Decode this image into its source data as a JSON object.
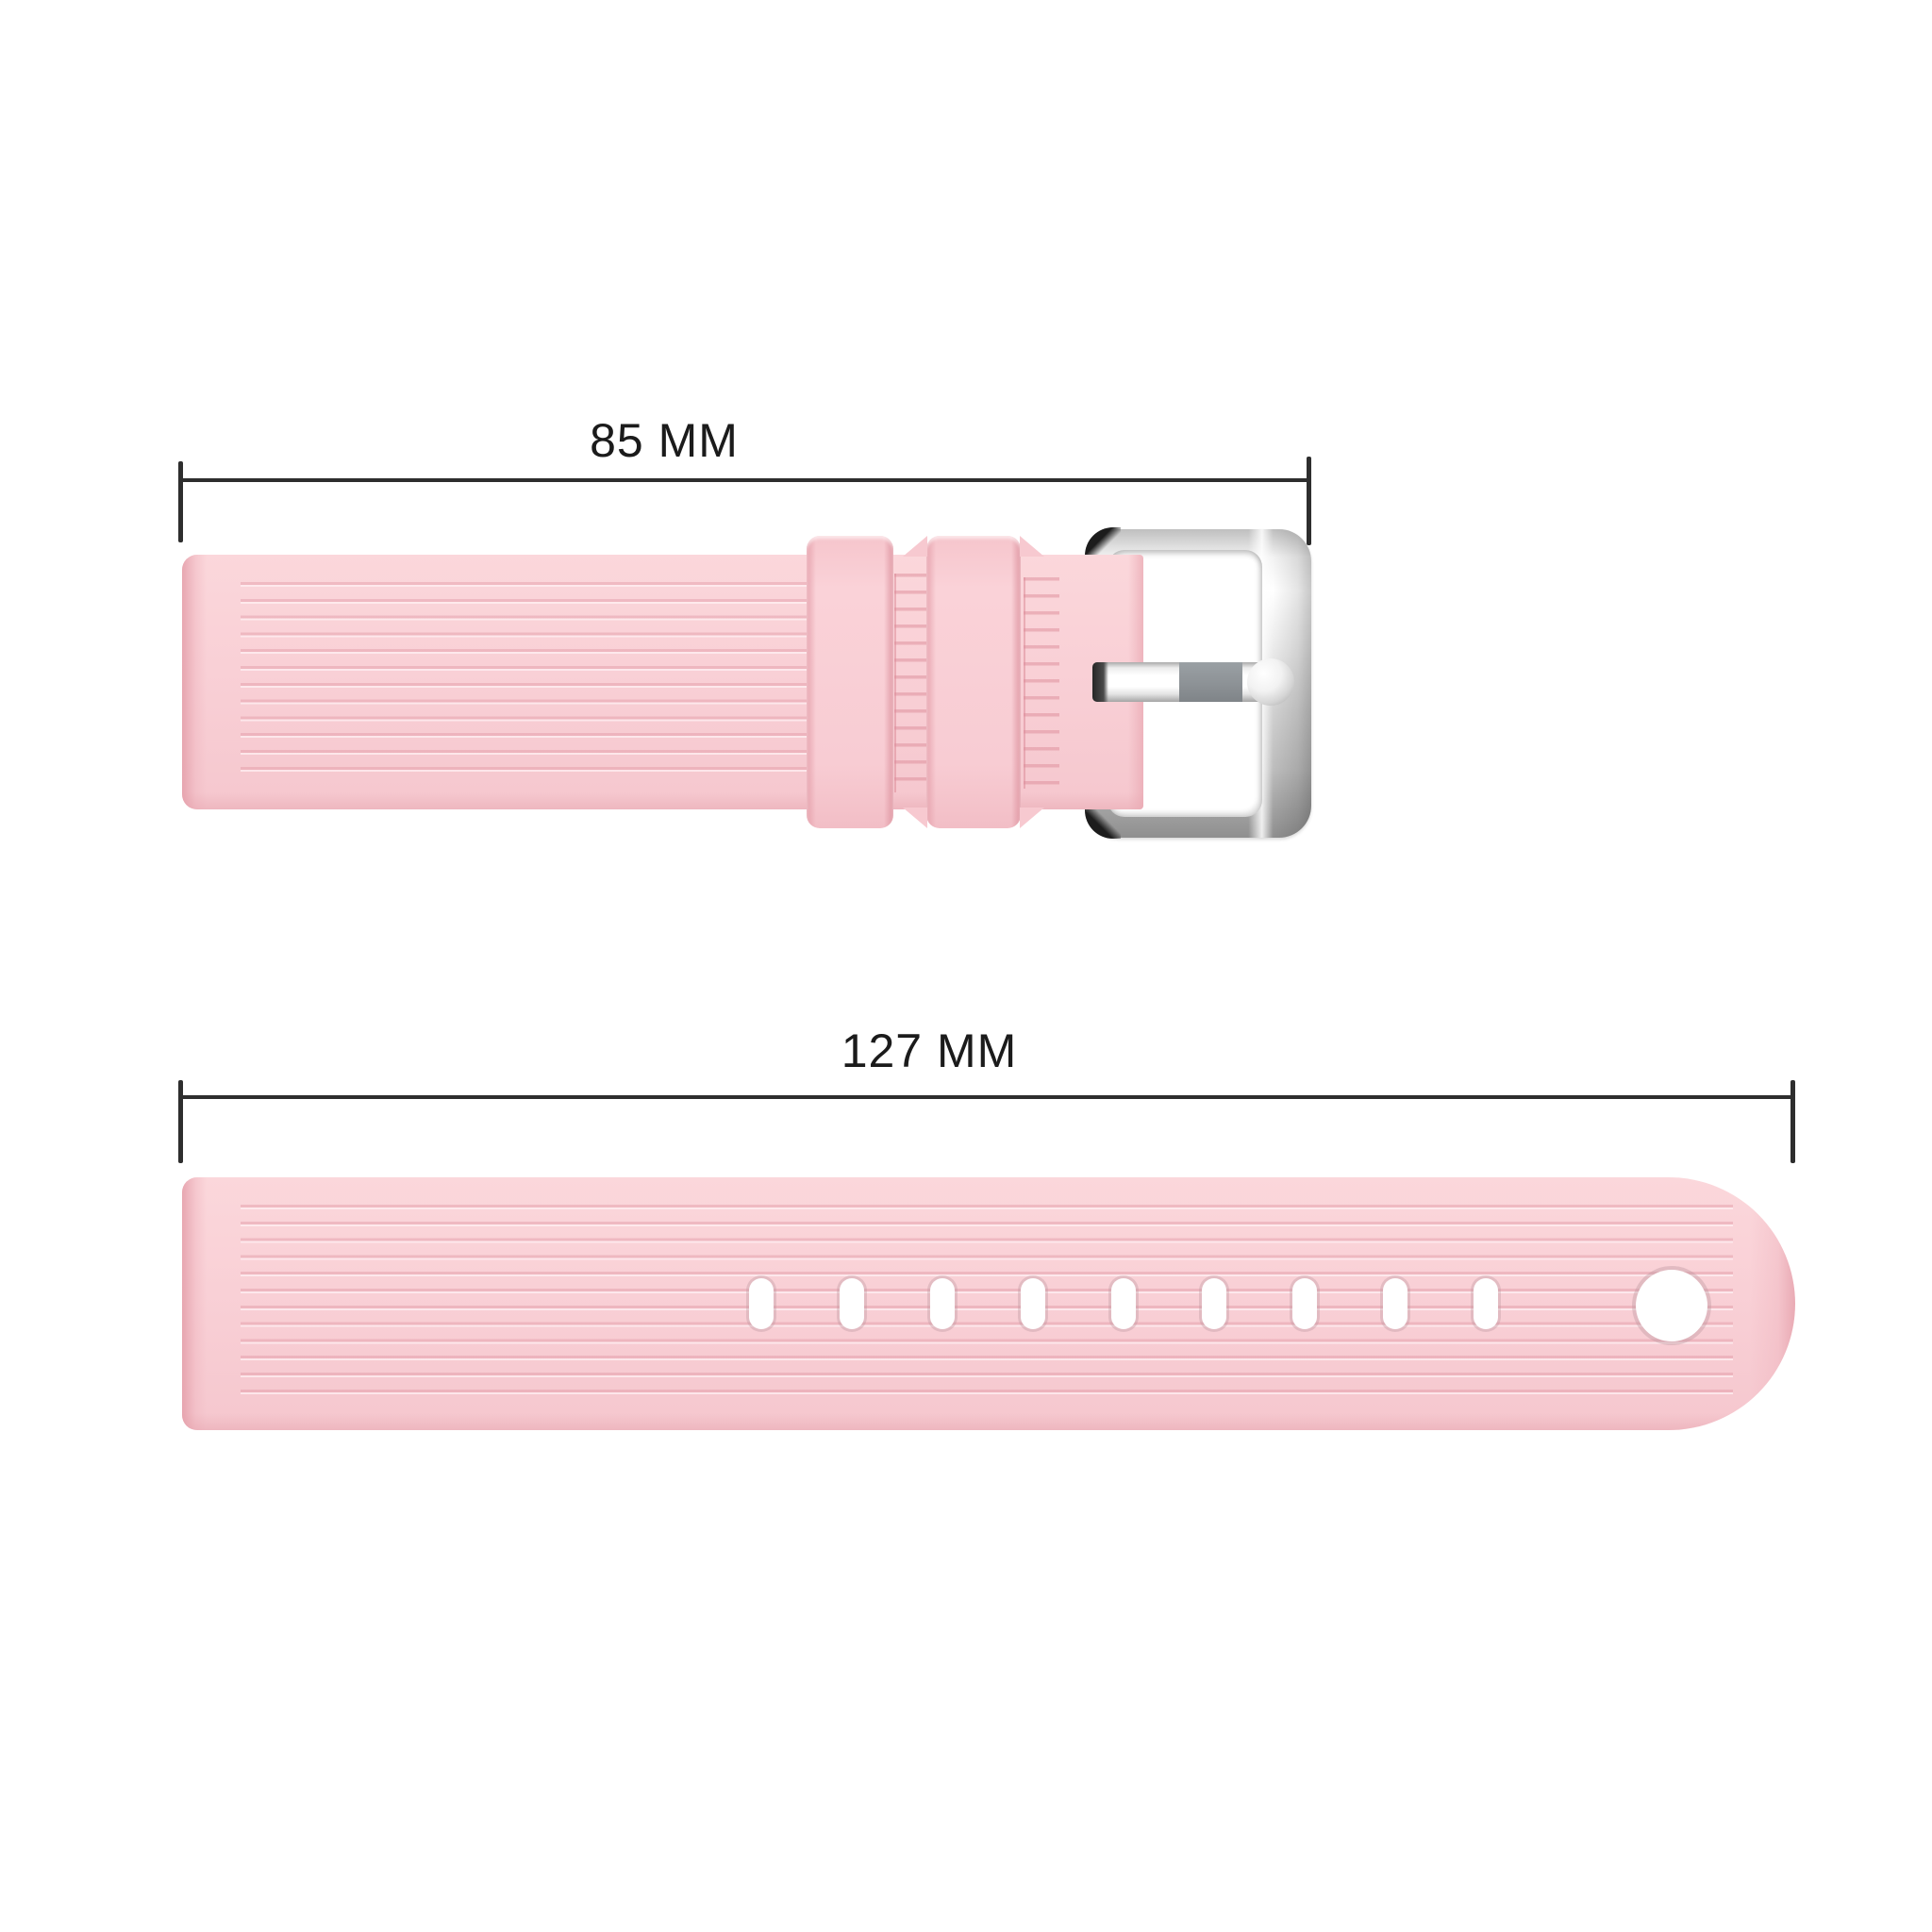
{
  "diagram": {
    "background_color": "#ffffff",
    "line_color": "#2e2e2e",
    "text_color": "#1b1b1b",
    "measurements": {
      "top": {
        "label": "85 MM"
      },
      "bottom": {
        "label": "127 MM"
      }
    },
    "product": {
      "item": "silicone-watch-band",
      "band_color": "#f9d0d6",
      "band_edge_color": "#e9a9b3",
      "buckle_finish": "silver",
      "buckle_dark_accent": "#1c1c1c",
      "prong_gray": "#8d9296",
      "small_hole_count": 9,
      "large_hole_count": 1
    }
  }
}
